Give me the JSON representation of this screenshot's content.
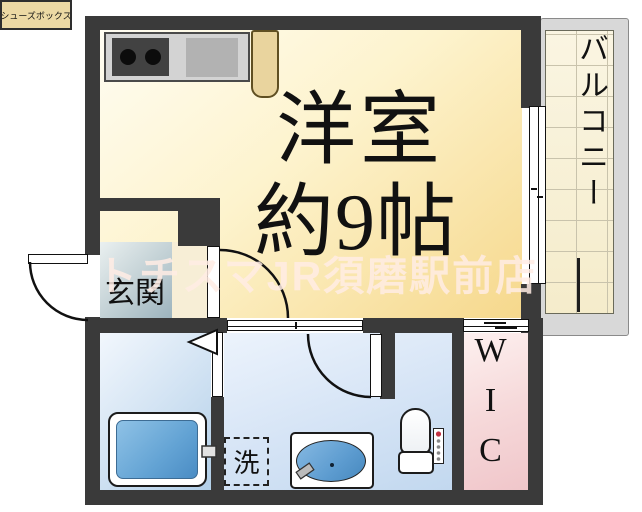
{
  "floorplan": {
    "title": "1K apartment floor plan",
    "watermark": {
      "text": "トチスマJR須磨駅前店",
      "color": "rgba(255,236,228,0.85)"
    },
    "rooms": {
      "main_room": {
        "line1": "洋室",
        "line2": "約9帖"
      },
      "balcony": {
        "label": "バルコニー"
      },
      "entrance": {
        "label": "玄関"
      },
      "shoe_box": {
        "label": "シューズボックス"
      },
      "laundry": {
        "label": "洗"
      },
      "wic": {
        "label": "WIC"
      }
    },
    "fixtures": [
      "kitchen-stove",
      "kitchen-sink",
      "refrigerator-slot",
      "bathtub",
      "vanity-sink",
      "toilet",
      "washlet-panel",
      "laundry-pan",
      "shoe-box"
    ],
    "colors": {
      "wall": "#3a3a3a",
      "main_room_floor": "#f6d88c",
      "entrance_floor": "#9db4be",
      "wet_area_floor": "#c2d8ef",
      "wic_floor": "#f0c6ca",
      "balcony_tile": "#f7f1da",
      "tub_water": "#4a8cc4",
      "accent_tan": "#e9d49e",
      "washlet_power_dot": "#c23344"
    }
  }
}
